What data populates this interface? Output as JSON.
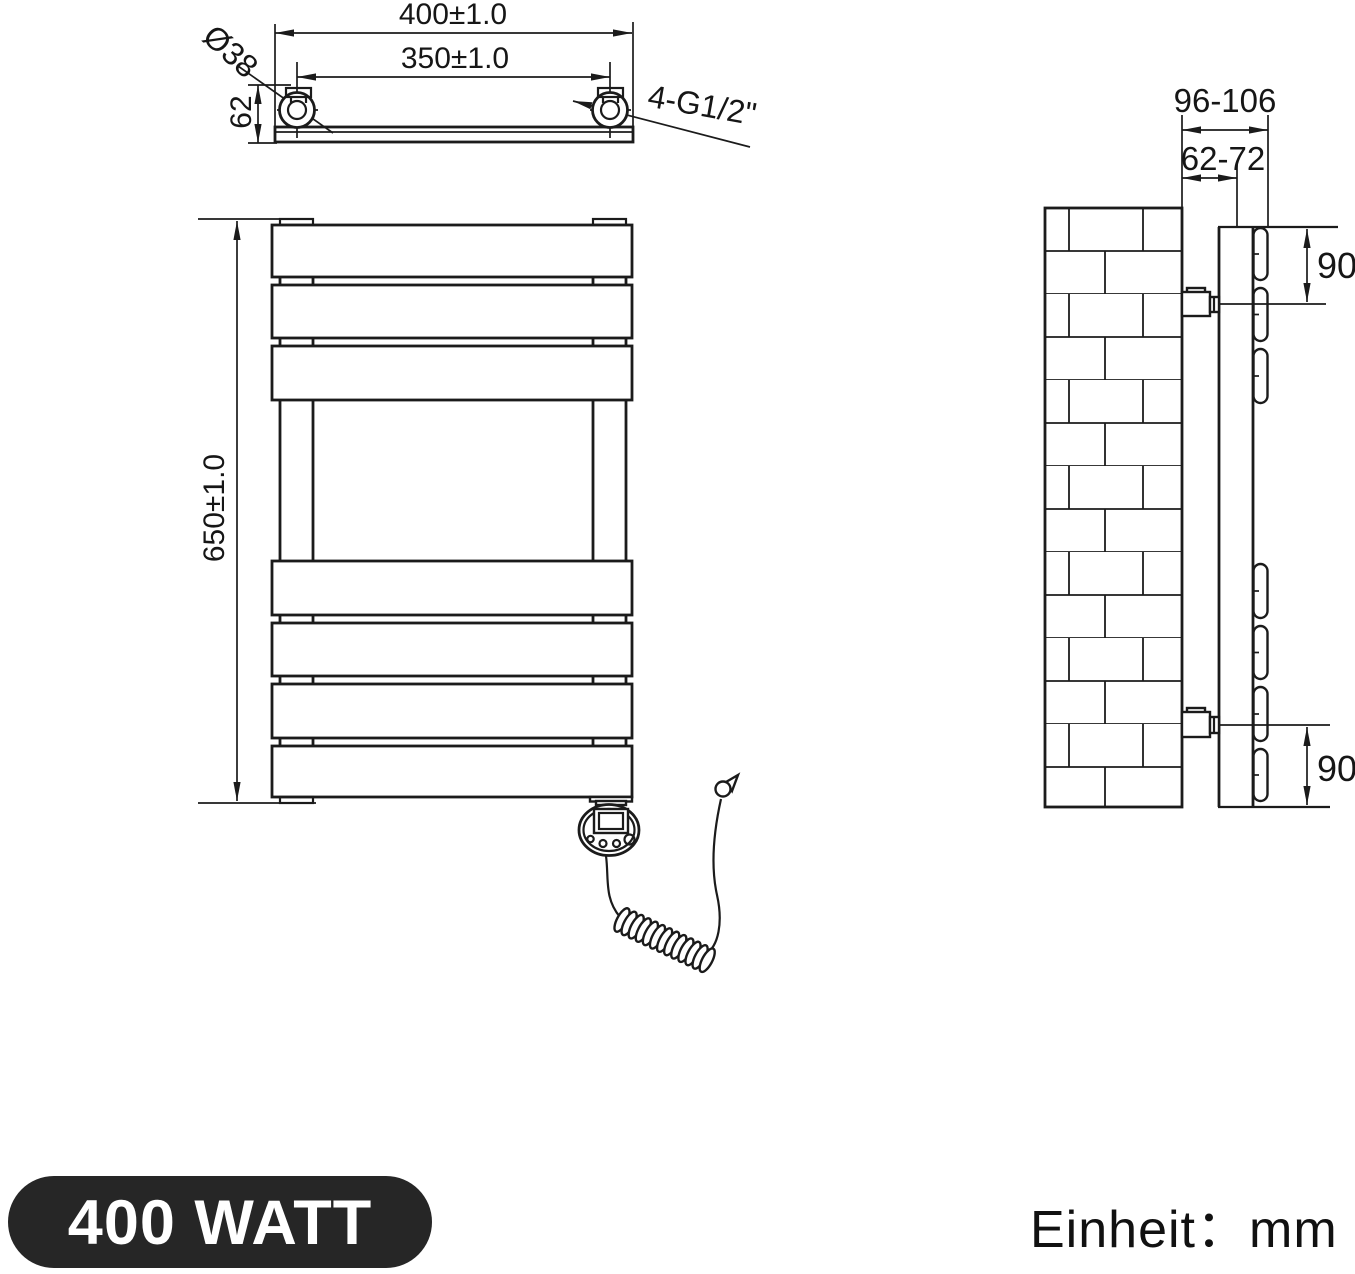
{
  "top_view": {
    "width_total": "400±1.0",
    "hole_spacing": "350±1.0",
    "depth": "62",
    "tube_diameter": "Ø38",
    "thread_spec": "4-G1/2\""
  },
  "front_view": {
    "height_total": "650±1.0"
  },
  "side_view": {
    "wall_to_front": "96-106",
    "wall_to_bracket": "62-72",
    "top_port_offset": "90",
    "bottom_port_offset": "90"
  },
  "footer": {
    "power_label": "400 WATT",
    "unit_label": "Einheit：mm"
  },
  "colors": {
    "ink": "#1b1b1b",
    "badge_bg": "#262626",
    "badge_text": "#ffffff"
  }
}
